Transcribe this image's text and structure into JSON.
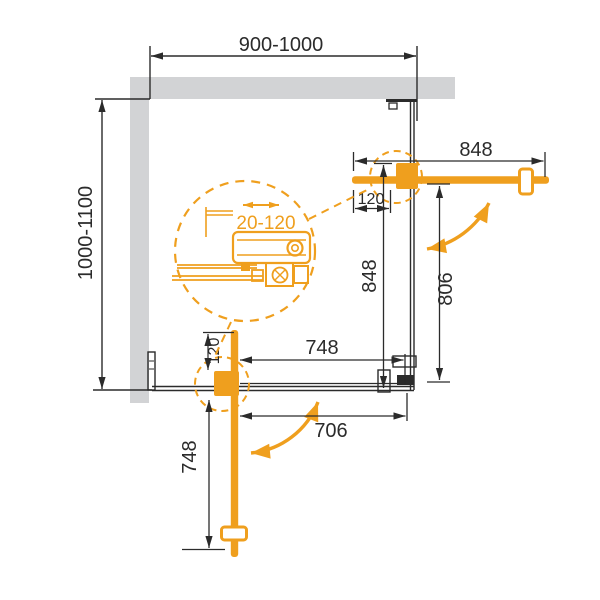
{
  "drawing": {
    "type": "shower-enclosure-plan-view",
    "colors": {
      "accent_orange": "#ef9f1e",
      "wall_gray": "#d2d3d5",
      "line_dark": "#2b2b2b"
    },
    "labels": {
      "width_range": "900-1000",
      "depth_range": "1000-1100",
      "right_door": {
        "open_width": "848",
        "pivot_offset": "120",
        "panel_height": "848",
        "clear_opening": "806"
      },
      "bottom_door": {
        "panel_width": "748",
        "pivot_offset": "120",
        "fixed_width": "706",
        "open_length": "748"
      },
      "detail": {
        "adjustment_range": "20-120"
      }
    }
  }
}
